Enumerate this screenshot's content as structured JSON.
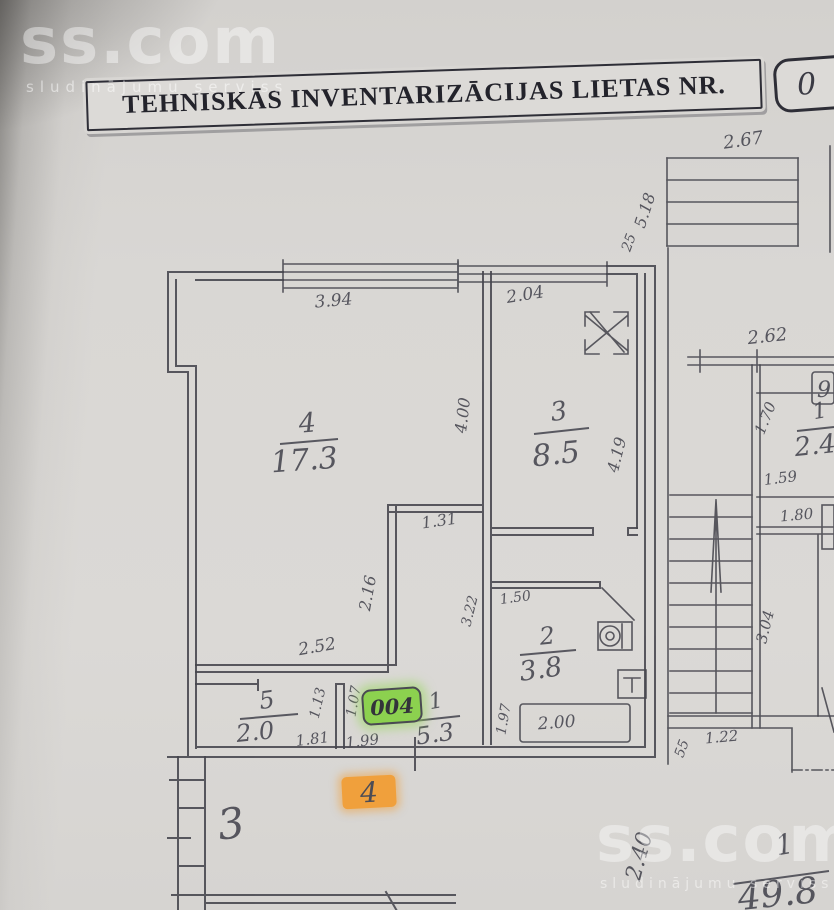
{
  "watermark_top": {
    "brand": "ss.com",
    "subtitle": "sludinājumu serviss"
  },
  "watermark_bottom": {
    "brand": "ss.com",
    "subtitle": "sludinājumu serviss"
  },
  "header": {
    "title": "TEHNISKĀS INVENTARIZĀCIJAS LIETAS NR.",
    "case_number_visible": "0"
  },
  "plan": {
    "rooms": {
      "r4": {
        "no": "4",
        "area": "17.3"
      },
      "r3": {
        "no": "3",
        "area": "8.5"
      },
      "r2": {
        "no": "2",
        "area": "3.8"
      },
      "r5": {
        "no": "5",
        "area": "2.0"
      },
      "r1": {
        "no": "1",
        "area": "5.3"
      },
      "neighbor": {
        "no": "1",
        "area": "2.4"
      },
      "total": {
        "no": "1",
        "area": "49.8"
      }
    },
    "labels": {
      "floor_mark": "3",
      "apartment_highlight": "4",
      "door_sticker": "004",
      "neighbor_box": "9"
    },
    "measurements": {
      "m394": "3.94",
      "m204": "2.04",
      "m267": "2.67",
      "m518": "5.18",
      "m25": "25",
      "m262": "2.62",
      "m400": "4.00",
      "m419": "4.19",
      "m131": "1.31",
      "m216": "2.16",
      "m252": "2.52",
      "m113": "1.13",
      "m107": "1.07",
      "m181": "1.81",
      "m199": "1.99",
      "m150": "1.50",
      "m322": "3.22",
      "m197": "1.97",
      "m200": "2.00",
      "m170": "1.70",
      "m159": "1.59",
      "m180": "1.80",
      "m304": "3.04",
      "m122": "1.22",
      "m55": "55",
      "m240": "2.40"
    },
    "colors": {
      "highlight_green": "#8cd14f",
      "highlight_orange": "#f0a03c",
      "ink": "#45454d"
    }
  }
}
